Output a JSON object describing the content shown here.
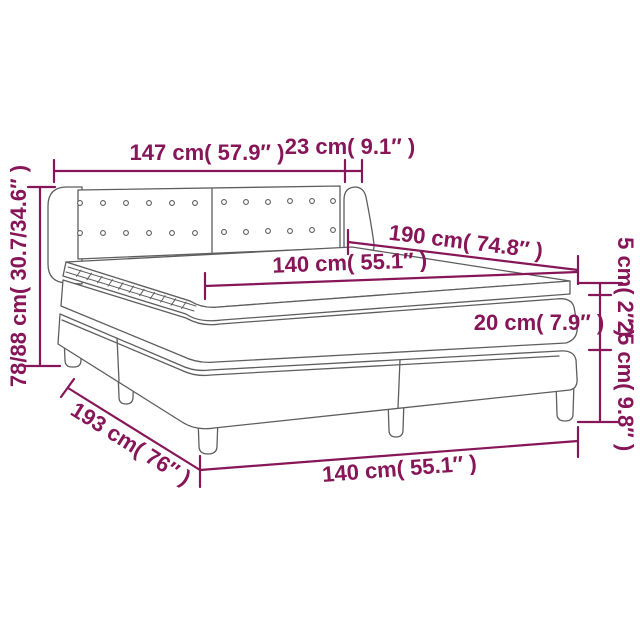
{
  "diagram": {
    "subject": "box-spring-bed-with-tufted-headboard-dimension-drawing",
    "accent_color": "#871659",
    "line_color": "#5e5e5e",
    "dimensions": {
      "headboard_width": "147 cm( 57.9″ )",
      "headboard_depth": "23 cm( 9.1″ )",
      "bed_length": "190 cm( 74.8″ )",
      "mattress_width": "140 cm( 55.1″ )",
      "topper_height": "5 cm( 2″ )",
      "mattress_height": "20 cm( 7.9″ )",
      "base_height": "25 cm( 9.8″ )",
      "headboard_height": "78/88 cm( 30.7/34.6″ )",
      "total_length": "193 cm( 76″ )",
      "base_width": "140 cm( 55.1″ )"
    }
  }
}
